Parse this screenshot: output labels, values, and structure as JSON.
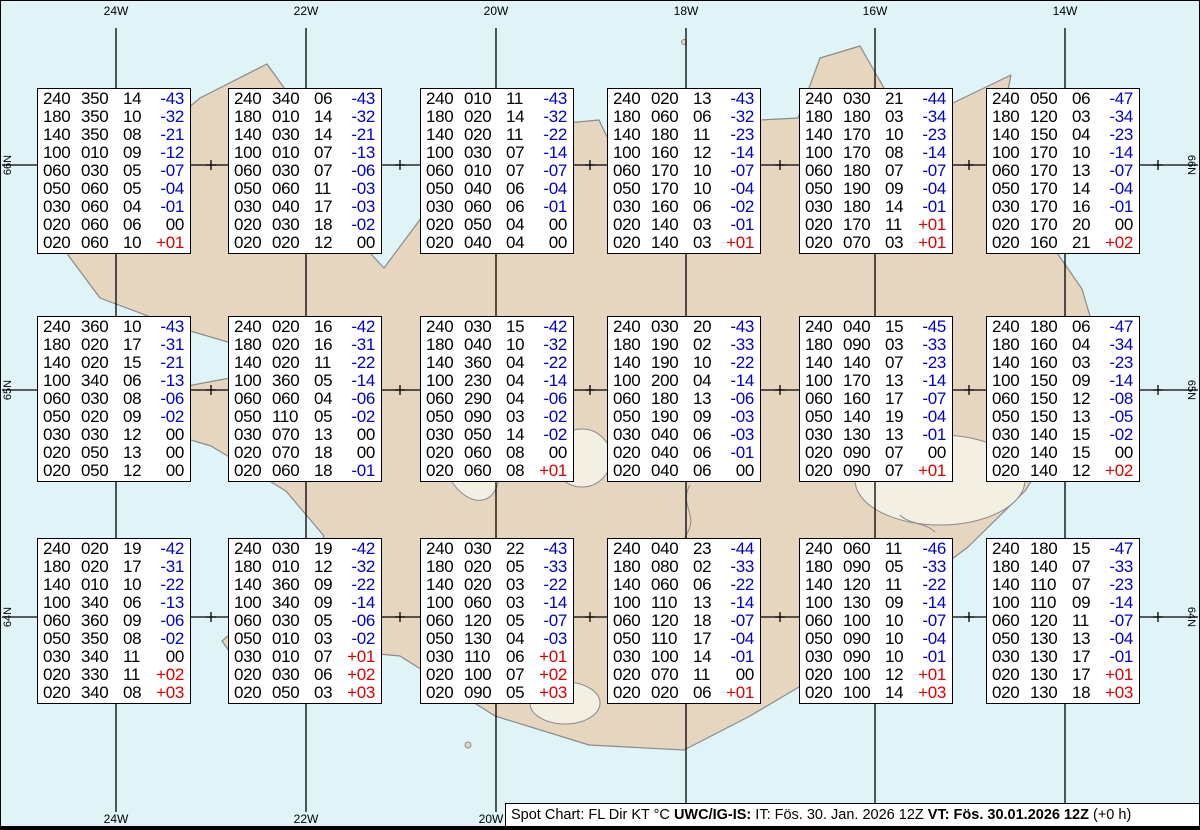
{
  "map": {
    "top_labels": [
      "24W",
      "22W",
      "20W",
      "18W",
      "16W",
      "14W"
    ],
    "bottom_labels": [
      "24W",
      "22W",
      "20W"
    ],
    "left_labels": [
      "66N",
      "65N",
      "64N"
    ],
    "right_labels": [
      "66N",
      "65N",
      "64N"
    ]
  },
  "colors": {
    "ocean": "#e0f4f8",
    "land": "#e6d6bf",
    "coast": "#8a8a8a",
    "temp_negative": "#0000cc",
    "temp_positive": "#dd0000",
    "text": "#000000"
  },
  "status_bar": {
    "segments": [
      {
        "text": "Spot Chart: FL Dir KT °C ",
        "bold": false
      },
      {
        "text": "UWC/IG-IS:",
        "bold": true
      },
      {
        "text": " IT: Fös. 30. Jan. 2026 12Z ",
        "bold": false
      },
      {
        "text": "VT: Fös. 30.01.2026 12Z",
        "bold": true
      },
      {
        "text": " (+0 h)",
        "bold": false
      }
    ]
  },
  "spot_tables": {
    "columns": [
      "FL",
      "Dir",
      "KT",
      "C"
    ],
    "boxes": [
      {
        "col": 0,
        "row": 0,
        "rows": [
          [
            "240",
            "350",
            "14",
            "-43"
          ],
          [
            "180",
            "350",
            "10",
            "-32"
          ],
          [
            "140",
            "350",
            "08",
            "-21"
          ],
          [
            "100",
            "010",
            "09",
            "-12"
          ],
          [
            "060",
            "030",
            "05",
            "-07"
          ],
          [
            "050",
            "060",
            "05",
            "-04"
          ],
          [
            "030",
            "060",
            "04",
            "-01"
          ],
          [
            "020",
            "060",
            "06",
            "00"
          ],
          [
            "020",
            "060",
            "10",
            "+01"
          ]
        ]
      },
      {
        "col": 1,
        "row": 0,
        "rows": [
          [
            "240",
            "340",
            "06",
            "-43"
          ],
          [
            "180",
            "010",
            "14",
            "-32"
          ],
          [
            "140",
            "030",
            "14",
            "-21"
          ],
          [
            "100",
            "010",
            "07",
            "-13"
          ],
          [
            "060",
            "030",
            "07",
            "-06"
          ],
          [
            "050",
            "060",
            "11",
            "-03"
          ],
          [
            "030",
            "040",
            "17",
            "-03"
          ],
          [
            "020",
            "030",
            "18",
            "-02"
          ],
          [
            "020",
            "020",
            "12",
            "00"
          ]
        ]
      },
      {
        "col": 2,
        "row": 0,
        "rows": [
          [
            "240",
            "010",
            "11",
            "-43"
          ],
          [
            "180",
            "020",
            "14",
            "-32"
          ],
          [
            "140",
            "020",
            "11",
            "-22"
          ],
          [
            "100",
            "030",
            "07",
            "-14"
          ],
          [
            "060",
            "010",
            "07",
            "-07"
          ],
          [
            "050",
            "040",
            "06",
            "-04"
          ],
          [
            "030",
            "060",
            "06",
            "-01"
          ],
          [
            "020",
            "050",
            "04",
            "00"
          ],
          [
            "020",
            "040",
            "04",
            "00"
          ]
        ]
      },
      {
        "col": 3,
        "row": 0,
        "rows": [
          [
            "240",
            "020",
            "13",
            "-43"
          ],
          [
            "180",
            "060",
            "06",
            "-32"
          ],
          [
            "140",
            "180",
            "11",
            "-23"
          ],
          [
            "100",
            "160",
            "12",
            "-14"
          ],
          [
            "060",
            "170",
            "10",
            "-07"
          ],
          [
            "050",
            "170",
            "10",
            "-04"
          ],
          [
            "030",
            "160",
            "06",
            "-02"
          ],
          [
            "020",
            "140",
            "03",
            "-01"
          ],
          [
            "020",
            "140",
            "03",
            "+01"
          ]
        ]
      },
      {
        "col": 4,
        "row": 0,
        "rows": [
          [
            "240",
            "030",
            "21",
            "-44"
          ],
          [
            "180",
            "180",
            "03",
            "-34"
          ],
          [
            "140",
            "170",
            "10",
            "-23"
          ],
          [
            "100",
            "170",
            "08",
            "-14"
          ],
          [
            "060",
            "180",
            "07",
            "-07"
          ],
          [
            "050",
            "190",
            "09",
            "-04"
          ],
          [
            "030",
            "180",
            "14",
            "-01"
          ],
          [
            "020",
            "170",
            "11",
            "+01"
          ],
          [
            "020",
            "070",
            "03",
            "+01"
          ]
        ]
      },
      {
        "col": 5,
        "row": 0,
        "rows": [
          [
            "240",
            "050",
            "06",
            "-47"
          ],
          [
            "180",
            "120",
            "03",
            "-34"
          ],
          [
            "140",
            "150",
            "04",
            "-23"
          ],
          [
            "100",
            "170",
            "10",
            "-14"
          ],
          [
            "060",
            "170",
            "13",
            "-07"
          ],
          [
            "050",
            "170",
            "14",
            "-04"
          ],
          [
            "030",
            "170",
            "16",
            "-01"
          ],
          [
            "020",
            "170",
            "20",
            "00"
          ],
          [
            "020",
            "160",
            "21",
            "+02"
          ]
        ]
      },
      {
        "col": 0,
        "row": 1,
        "rows": [
          [
            "240",
            "360",
            "10",
            "-43"
          ],
          [
            "180",
            "020",
            "17",
            "-31"
          ],
          [
            "140",
            "020",
            "15",
            "-21"
          ],
          [
            "100",
            "340",
            "06",
            "-13"
          ],
          [
            "060",
            "030",
            "08",
            "-06"
          ],
          [
            "050",
            "020",
            "09",
            "-02"
          ],
          [
            "030",
            "030",
            "12",
            "00"
          ],
          [
            "020",
            "050",
            "13",
            "00"
          ],
          [
            "020",
            "050",
            "12",
            "00"
          ]
        ]
      },
      {
        "col": 1,
        "row": 1,
        "rows": [
          [
            "240",
            "020",
            "16",
            "-42"
          ],
          [
            "180",
            "020",
            "16",
            "-31"
          ],
          [
            "140",
            "020",
            "11",
            "-22"
          ],
          [
            "100",
            "360",
            "05",
            "-14"
          ],
          [
            "060",
            "060",
            "04",
            "-06"
          ],
          [
            "050",
            "110",
            "05",
            "-02"
          ],
          [
            "030",
            "070",
            "13",
            "00"
          ],
          [
            "020",
            "070",
            "18",
            "00"
          ],
          [
            "020",
            "060",
            "18",
            "-01"
          ]
        ]
      },
      {
        "col": 2,
        "row": 1,
        "rows": [
          [
            "240",
            "030",
            "15",
            "-42"
          ],
          [
            "180",
            "040",
            "10",
            "-32"
          ],
          [
            "140",
            "360",
            "04",
            "-22"
          ],
          [
            "100",
            "230",
            "04",
            "-14"
          ],
          [
            "060",
            "290",
            "04",
            "-06"
          ],
          [
            "050",
            "090",
            "03",
            "-02"
          ],
          [
            "030",
            "050",
            "14",
            "-02"
          ],
          [
            "020",
            "060",
            "08",
            "00"
          ],
          [
            "020",
            "060",
            "08",
            "+01"
          ]
        ]
      },
      {
        "col": 3,
        "row": 1,
        "rows": [
          [
            "240",
            "030",
            "20",
            "-43"
          ],
          [
            "180",
            "190",
            "02",
            "-33"
          ],
          [
            "140",
            "190",
            "10",
            "-22"
          ],
          [
            "100",
            "200",
            "04",
            "-14"
          ],
          [
            "060",
            "180",
            "13",
            "-06"
          ],
          [
            "050",
            "190",
            "09",
            "-03"
          ],
          [
            "030",
            "040",
            "06",
            "-03"
          ],
          [
            "020",
            "040",
            "06",
            "-01"
          ],
          [
            "020",
            "040",
            "06",
            "00"
          ]
        ]
      },
      {
        "col": 4,
        "row": 1,
        "rows": [
          [
            "240",
            "040",
            "15",
            "-45"
          ],
          [
            "180",
            "090",
            "03",
            "-33"
          ],
          [
            "140",
            "140",
            "07",
            "-23"
          ],
          [
            "100",
            "170",
            "13",
            "-14"
          ],
          [
            "060",
            "160",
            "17",
            "-07"
          ],
          [
            "050",
            "140",
            "19",
            "-04"
          ],
          [
            "030",
            "130",
            "13",
            "-01"
          ],
          [
            "020",
            "090",
            "07",
            "00"
          ],
          [
            "020",
            "090",
            "07",
            "+01"
          ]
        ]
      },
      {
        "col": 5,
        "row": 1,
        "rows": [
          [
            "240",
            "180",
            "06",
            "-47"
          ],
          [
            "180",
            "160",
            "04",
            "-34"
          ],
          [
            "140",
            "160",
            "03",
            "-23"
          ],
          [
            "100",
            "150",
            "09",
            "-14"
          ],
          [
            "060",
            "150",
            "12",
            "-08"
          ],
          [
            "050",
            "150",
            "13",
            "-05"
          ],
          [
            "030",
            "140",
            "15",
            "-02"
          ],
          [
            "020",
            "140",
            "15",
            "00"
          ],
          [
            "020",
            "140",
            "12",
            "+02"
          ]
        ]
      },
      {
        "col": 0,
        "row": 2,
        "rows": [
          [
            "240",
            "020",
            "19",
            "-42"
          ],
          [
            "180",
            "020",
            "17",
            "-31"
          ],
          [
            "140",
            "010",
            "10",
            "-22"
          ],
          [
            "100",
            "340",
            "06",
            "-13"
          ],
          [
            "060",
            "360",
            "09",
            "-06"
          ],
          [
            "050",
            "350",
            "08",
            "-02"
          ],
          [
            "030",
            "340",
            "11",
            "00"
          ],
          [
            "020",
            "330",
            "11",
            "+02"
          ],
          [
            "020",
            "340",
            "08",
            "+03"
          ]
        ]
      },
      {
        "col": 1,
        "row": 2,
        "rows": [
          [
            "240",
            "030",
            "19",
            "-42"
          ],
          [
            "180",
            "010",
            "12",
            "-32"
          ],
          [
            "140",
            "360",
            "09",
            "-22"
          ],
          [
            "100",
            "340",
            "09",
            "-14"
          ],
          [
            "060",
            "030",
            "05",
            "-06"
          ],
          [
            "050",
            "010",
            "03",
            "-02"
          ],
          [
            "030",
            "010",
            "07",
            "+01"
          ],
          [
            "020",
            "030",
            "06",
            "+02"
          ],
          [
            "020",
            "050",
            "03",
            "+03"
          ]
        ]
      },
      {
        "col": 2,
        "row": 2,
        "rows": [
          [
            "240",
            "030",
            "22",
            "-43"
          ],
          [
            "180",
            "020",
            "05",
            "-33"
          ],
          [
            "140",
            "020",
            "03",
            "-22"
          ],
          [
            "100",
            "060",
            "03",
            "-14"
          ],
          [
            "060",
            "120",
            "05",
            "-07"
          ],
          [
            "050",
            "130",
            "04",
            "-03"
          ],
          [
            "030",
            "110",
            "06",
            "+01"
          ],
          [
            "020",
            "100",
            "07",
            "+02"
          ],
          [
            "020",
            "090",
            "05",
            "+03"
          ]
        ]
      },
      {
        "col": 3,
        "row": 2,
        "rows": [
          [
            "240",
            "040",
            "23",
            "-44"
          ],
          [
            "180",
            "080",
            "02",
            "-33"
          ],
          [
            "140",
            "060",
            "06",
            "-22"
          ],
          [
            "100",
            "110",
            "13",
            "-14"
          ],
          [
            "060",
            "120",
            "18",
            "-07"
          ],
          [
            "050",
            "110",
            "17",
            "-04"
          ],
          [
            "030",
            "100",
            "14",
            "-01"
          ],
          [
            "020",
            "070",
            "11",
            "00"
          ],
          [
            "020",
            "020",
            "06",
            "+01"
          ]
        ]
      },
      {
        "col": 4,
        "row": 2,
        "rows": [
          [
            "240",
            "060",
            "11",
            "-46"
          ],
          [
            "180",
            "090",
            "05",
            "-33"
          ],
          [
            "140",
            "120",
            "11",
            "-22"
          ],
          [
            "100",
            "130",
            "09",
            "-14"
          ],
          [
            "060",
            "100",
            "10",
            "-07"
          ],
          [
            "050",
            "090",
            "10",
            "-04"
          ],
          [
            "030",
            "090",
            "10",
            "-01"
          ],
          [
            "020",
            "100",
            "12",
            "+01"
          ],
          [
            "020",
            "100",
            "14",
            "+03"
          ]
        ]
      },
      {
        "col": 5,
        "row": 2,
        "rows": [
          [
            "240",
            "180",
            "15",
            "-47"
          ],
          [
            "180",
            "140",
            "07",
            "-33"
          ],
          [
            "140",
            "110",
            "07",
            "-23"
          ],
          [
            "100",
            "110",
            "09",
            "-14"
          ],
          [
            "060",
            "120",
            "11",
            "-07"
          ],
          [
            "050",
            "130",
            "13",
            "-04"
          ],
          [
            "030",
            "130",
            "17",
            "-01"
          ],
          [
            "020",
            "130",
            "17",
            "+01"
          ],
          [
            "020",
            "130",
            "18",
            "+03"
          ]
        ]
      }
    ]
  }
}
